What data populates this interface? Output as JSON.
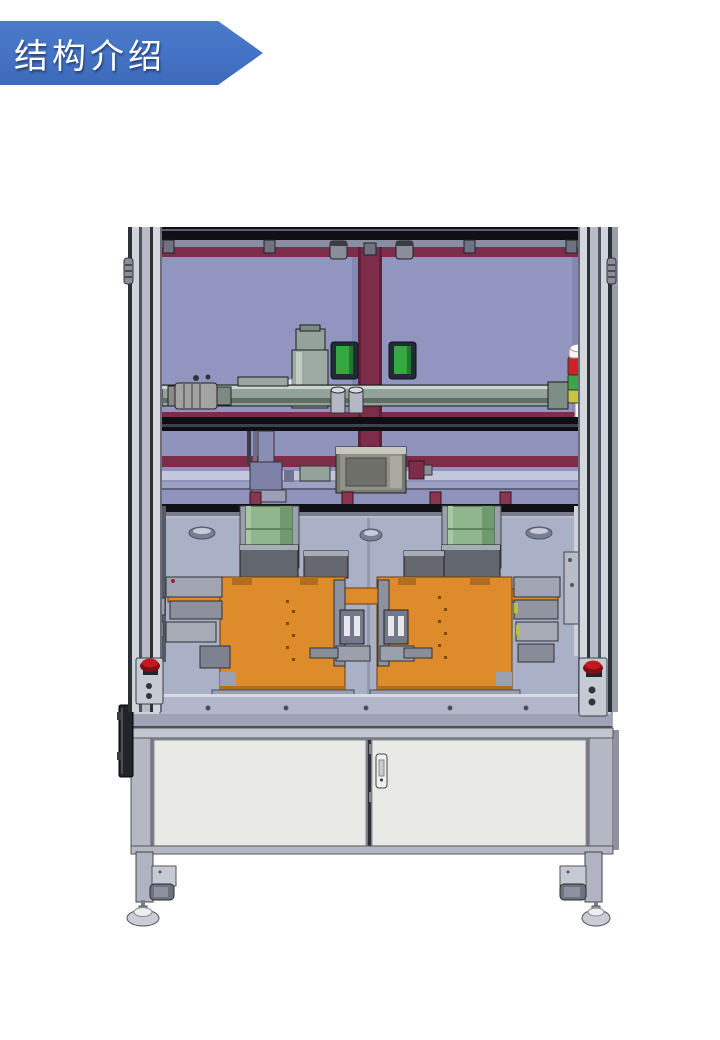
{
  "slide": {
    "title": "结构介绍"
  },
  "machine": {
    "palette": {
      "frame_aluminum": "#C9CDD6",
      "enclosure_panel": "#9295BF",
      "panel_frame_maroon": "#7D2C4A",
      "fixture_orange": "#DE8C2B",
      "bracket_green": "#8FB68C",
      "sensor_green": "#35A83F",
      "cabinet_door": "#E9E9E6",
      "table_deck": "#AAB0C6",
      "separator_black": "#101016"
    },
    "signal_tower": {
      "cap": "#F4F4F2",
      "red": "#CF2128",
      "green": "#3AA648",
      "yellow": "#C9C53E"
    },
    "estop_red": "#C41820"
  }
}
